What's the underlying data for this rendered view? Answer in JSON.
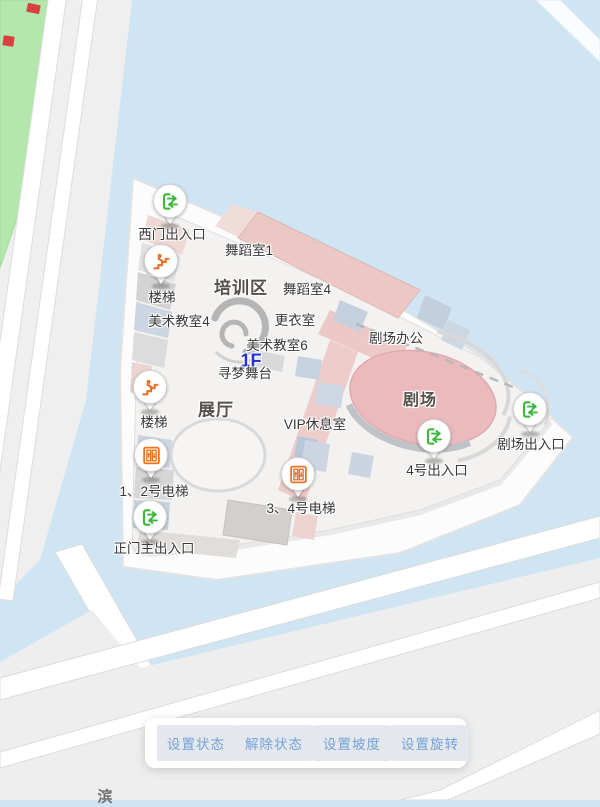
{
  "map": {
    "floor_indicator": "1F",
    "colors": {
      "water": "#cfe5f4",
      "park": "#b3e7ac",
      "land": "#eeeeee",
      "road": "#ffffff",
      "island": "#fcfcfc",
      "building_floor": "#f3f2f0",
      "room_pink": "#ebc8c4",
      "theater_pink": "#ecbabd",
      "room_bluegray": "#c9d4e1",
      "room_gray": "#d5d5d5",
      "icon_green": "#3eb73e",
      "icon_orange": "#e8732a",
      "label_text": "#383838",
      "zone_label_text": "#56504a",
      "floor_blue": "#2430dd",
      "button_text": "#74a3d9",
      "button_bg": "#e4e8ec",
      "status_marker_red": "#d94040"
    },
    "labels": [
      {
        "kind": "zone",
        "text": "培训区",
        "x": 241,
        "y": 286
      },
      {
        "kind": "zone",
        "text": "展厅",
        "x": 216,
        "y": 408
      },
      {
        "kind": "zone-small",
        "text": "剧场",
        "x": 420,
        "y": 398
      },
      {
        "kind": "floor",
        "text": "1F",
        "x": 251,
        "y": 361
      },
      {
        "kind": "room",
        "text": "舞蹈室1",
        "x": 249,
        "y": 249
      },
      {
        "kind": "room",
        "text": "舞蹈室4",
        "x": 307,
        "y": 288
      },
      {
        "kind": "room",
        "text": "美术教室4",
        "x": 179,
        "y": 320
      },
      {
        "kind": "room",
        "text": "更衣室",
        "x": 295,
        "y": 319
      },
      {
        "kind": "room",
        "text": "美术教室6",
        "x": 277,
        "y": 344
      },
      {
        "kind": "room",
        "text": "寻梦舞台",
        "x": 245,
        "y": 372
      },
      {
        "kind": "room",
        "text": "剧场办公",
        "x": 396,
        "y": 337
      },
      {
        "kind": "room",
        "text": "VIP休息室",
        "x": 315,
        "y": 423
      }
    ],
    "pois": [
      {
        "icon": "entrance-exit-icon",
        "label": "西门出入口",
        "px": 170,
        "py": 201,
        "lx": 172,
        "ly": 233
      },
      {
        "icon": "stairs-icon",
        "label": "楼梯",
        "px": 161,
        "py": 261,
        "lx": 162,
        "ly": 296
      },
      {
        "icon": "stairs-icon",
        "label": "楼梯",
        "px": 150,
        "py": 387,
        "lx": 154,
        "ly": 421
      },
      {
        "icon": "elevator-icon",
        "label": "1、2号电梯",
        "px": 151,
        "py": 455,
        "lx": 154,
        "ly": 490
      },
      {
        "icon": "entrance-exit-icon",
        "label": "正门主出入口",
        "px": 150,
        "py": 517,
        "lx": 154,
        "ly": 547
      },
      {
        "icon": "elevator-icon",
        "label": "3、4号电梯",
        "px": 298,
        "py": 474,
        "lx": 301,
        "ly": 507
      },
      {
        "icon": "entrance-exit-icon",
        "label": "4号出入口",
        "px": 434,
        "py": 436,
        "lx": 437,
        "ly": 469
      },
      {
        "icon": "entrance-exit-icon",
        "label": "剧场出入口",
        "px": 530,
        "py": 409,
        "lx": 531,
        "ly": 443
      }
    ],
    "status_markers": [
      {
        "x": 27,
        "y": 4,
        "w": 13,
        "h": 9,
        "rot": 12
      },
      {
        "x": 3,
        "y": 36,
        "w": 11,
        "h": 10,
        "rot": 8
      }
    ],
    "road_label_fragment": {
      "text": "滨",
      "x": 105,
      "y": 796
    }
  },
  "toolbar": {
    "buttons": [
      {
        "label": "设置状态"
      },
      {
        "label": "解除状态"
      },
      {
        "label": "设置坡度"
      },
      {
        "label": "设置旋转"
      }
    ]
  }
}
